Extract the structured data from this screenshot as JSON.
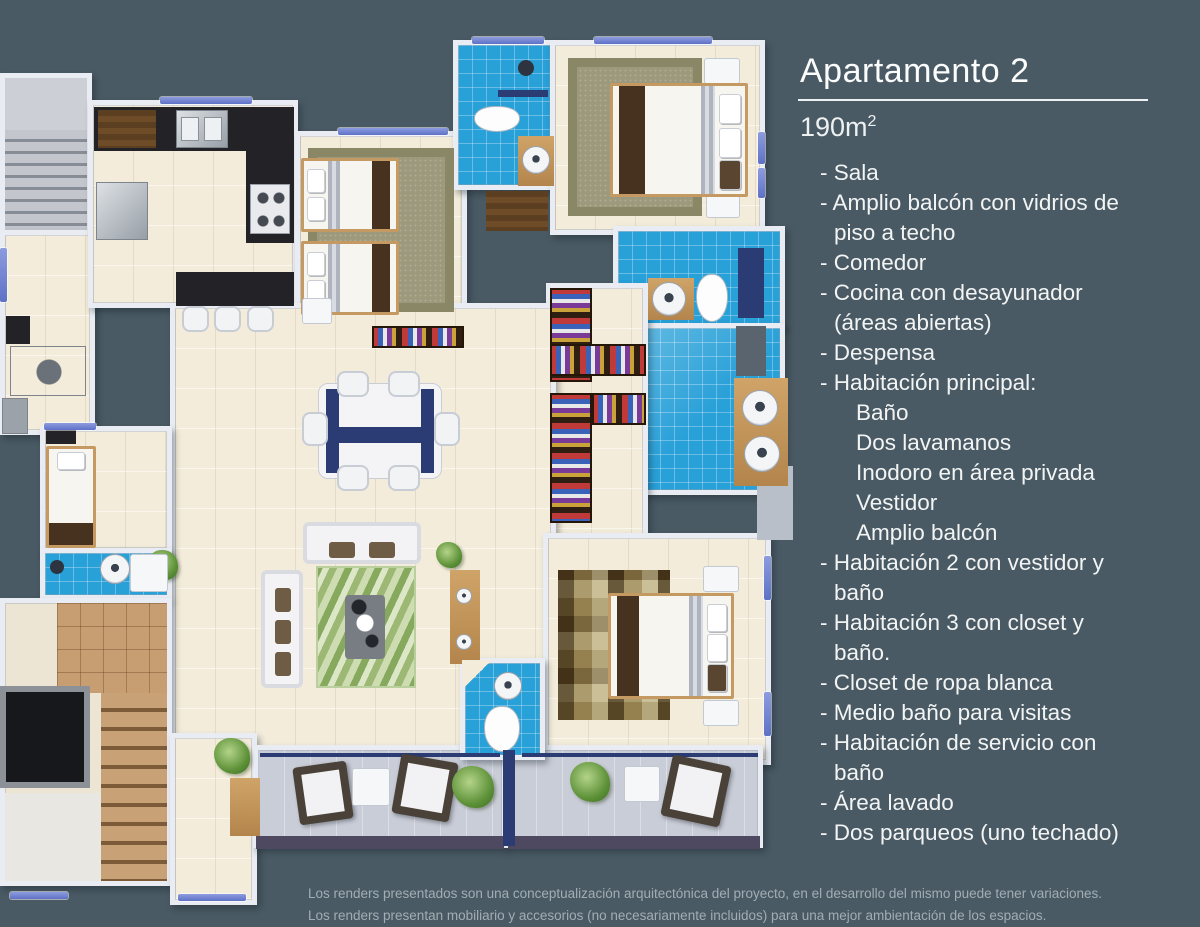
{
  "panel": {
    "title": "Apartamento 2",
    "area": "190m",
    "area_sup": "2",
    "features": [
      {
        "type": "item",
        "text": "- Sala"
      },
      {
        "type": "item",
        "text": "- Amplio balcón con vidrios de"
      },
      {
        "type": "cont",
        "text": "piso a techo"
      },
      {
        "type": "item",
        "text": "- Comedor"
      },
      {
        "type": "item",
        "text": "- Cocina con desayunador"
      },
      {
        "type": "cont",
        "text": "(áreas abiertas)"
      },
      {
        "type": "item",
        "text": "- Despensa"
      },
      {
        "type": "item",
        "text": "- Habitación principal:"
      },
      {
        "type": "sub",
        "text": "Baño"
      },
      {
        "type": "sub",
        "text": "Dos lavamanos"
      },
      {
        "type": "sub",
        "text": "Inodoro en área privada"
      },
      {
        "type": "sub",
        "text": "Vestidor"
      },
      {
        "type": "sub",
        "text": "Amplio balcón"
      },
      {
        "type": "item",
        "text": "- Habitación 2 con vestidor y"
      },
      {
        "type": "cont",
        "text": "baño"
      },
      {
        "type": "item",
        "text": "- Habitación 3 con closet y"
      },
      {
        "type": "cont",
        "text": "baño."
      },
      {
        "type": "item",
        "text": "- Closet de ropa blanca"
      },
      {
        "type": "item",
        "text": "- Medio baño para visitas"
      },
      {
        "type": "item",
        "text": "- Habitación de servicio con"
      },
      {
        "type": "cont",
        "text": "baño"
      },
      {
        "type": "item",
        "text": "- Área lavado"
      },
      {
        "type": "item",
        "text": "- Dos parqueos (uno techado)"
      }
    ]
  },
  "disclaimer": {
    "line1": "Los renders presentados son una conceptualización arquitectónica del proyecto, en el desarrollo del mismo puede tener variaciones.",
    "line2": "Los renders presentan mobiliario y accesorios (no necesariamente incluidos) para una mejor ambientación de los espacios."
  },
  "colors": {
    "background": "#4a5a64",
    "floor_cream": "#f3ecda",
    "tile_blue": "#28a0d8",
    "wall_white": "#e9edf3",
    "window_blue": "#7382d2",
    "accent_navy": "#2b3c74",
    "wood": "#c69a62",
    "counter_dark": "#232327",
    "text_white": "#f4f6f6",
    "disclaimer_gray": "#a2adb3"
  }
}
